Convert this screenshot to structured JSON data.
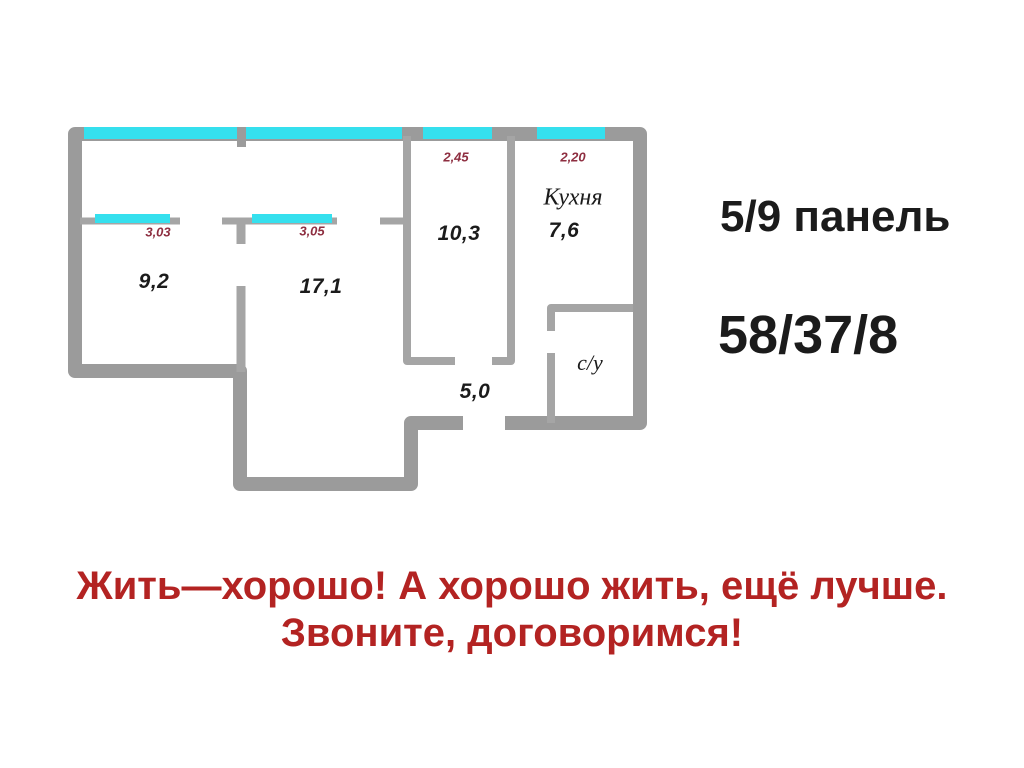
{
  "colors": {
    "wall": "#9b9b9b",
    "wall_inner": "#a5a5a5",
    "window": "#35e0ee",
    "dim": "#8e2e40",
    "slogan": "#b32322",
    "ink": "#1b1b1b"
  },
  "plan": {
    "rooms": {
      "room1_area": "9,2",
      "room2_area": "17,1",
      "room3_area": "10,3",
      "kitchen_name": "Кухня",
      "kitchen_area": "7,6",
      "hall_area": "5,0",
      "bathroom_name": "с/у"
    },
    "dimensions": {
      "room1_width": "3,03",
      "room2_width": "3,05",
      "room3_width": "2,45",
      "kitchen_width": "2,20"
    }
  },
  "info": {
    "building": "5/9 панель",
    "areas": "58/37/8"
  },
  "slogan": {
    "line1": "Жить—хорошо! А хорошо жить, ещё лучше.",
    "line2": "Звоните, договоримся!"
  }
}
